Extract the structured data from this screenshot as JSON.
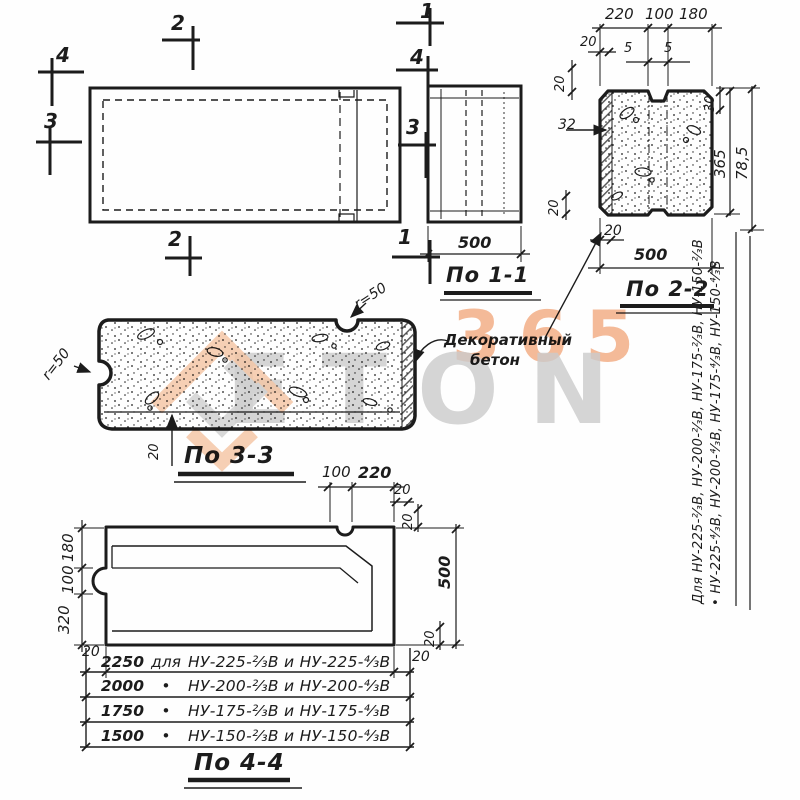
{
  "drawing": {
    "marks": {
      "m1": "1",
      "m2": "2",
      "m3": "3",
      "m4": "4"
    },
    "s11": {
      "label": "По 1-1",
      "d500": "500"
    },
    "s22": {
      "label": "По 2-2",
      "d220": "220",
      "d100": "100",
      "d180": "180",
      "d20": "20",
      "d5": "5",
      "d30": "30",
      "d32": "32",
      "d365": "365",
      "d785": "78,5",
      "d500": "500"
    },
    "s33": {
      "label": "По 3-3",
      "r50": "r=50",
      "d20": "20"
    },
    "s44": {
      "label": "По 4-4",
      "d100": "100",
      "d220": "220",
      "d20": "20",
      "d500": "500",
      "d180": "180",
      "d320": "320"
    },
    "leader": {
      "line1": "Декоративный",
      "line2": "бетон"
    },
    "side": {
      "line1": "Для НУ-225-²⁄₃В, НУ-200-²⁄₃В, НУ-175-²⁄₃В, НУ-150-²⁄₃В",
      "line2": "•  НУ-225-⁴⁄₃В, НУ-200-⁴⁄₃В, НУ-175-⁴⁄₃В, НУ-150-⁴⁄₃В"
    },
    "table": {
      "rows": [
        {
          "value": "2250",
          "sep": "для",
          "label": "НУ-225-²⁄₃В и НУ-225-⁴⁄₃В"
        },
        {
          "value": "2000",
          "sep": "•",
          "label": "НУ-200-²⁄₃В и НУ-200-⁴⁄₃В"
        },
        {
          "value": "1750",
          "sep": "•",
          "label": "НУ-175-²⁄₃В и НУ-175-⁴⁄₃В"
        },
        {
          "value": "1500",
          "sep": "•",
          "label": "НУ-150-²⁄₃В и НУ-150-⁴⁄₃В"
        }
      ]
    }
  },
  "watermark": {
    "number": "365",
    "word": "ЕТОN"
  },
  "colors": {
    "ink": "#1c1c1c",
    "paper": "#ffffff",
    "orange": "#f2a477",
    "peach": "#f5c5a3",
    "gray": "#cccccc"
  }
}
